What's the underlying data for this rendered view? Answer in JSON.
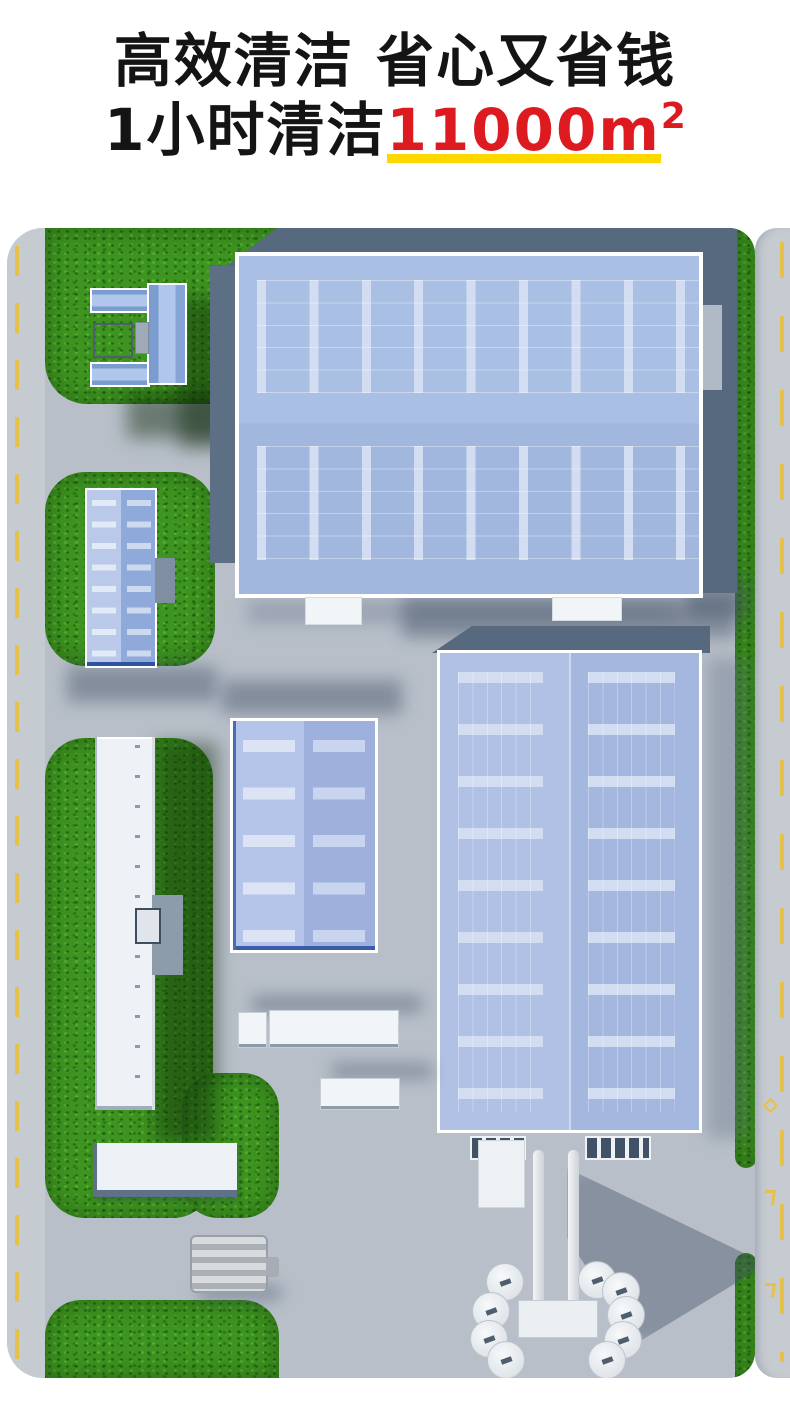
{
  "headline": {
    "line1": "高效清洁 省心又省钱",
    "line2_prefix": "1小时清洁",
    "line2_value": "11000m",
    "line2_sup": "2"
  },
  "colors": {
    "headline-text": "#141414",
    "headline-red": "#dd1a20",
    "underline-yellow": "#ffd800",
    "grass": "#3e9420",
    "pavement": "#b8bfc9",
    "road": "#c6cbd1",
    "road-marking": "#e6c14a",
    "slate": "#57697f",
    "roof-blue": "#aabfe4",
    "skylight": "#d2ddf2"
  }
}
